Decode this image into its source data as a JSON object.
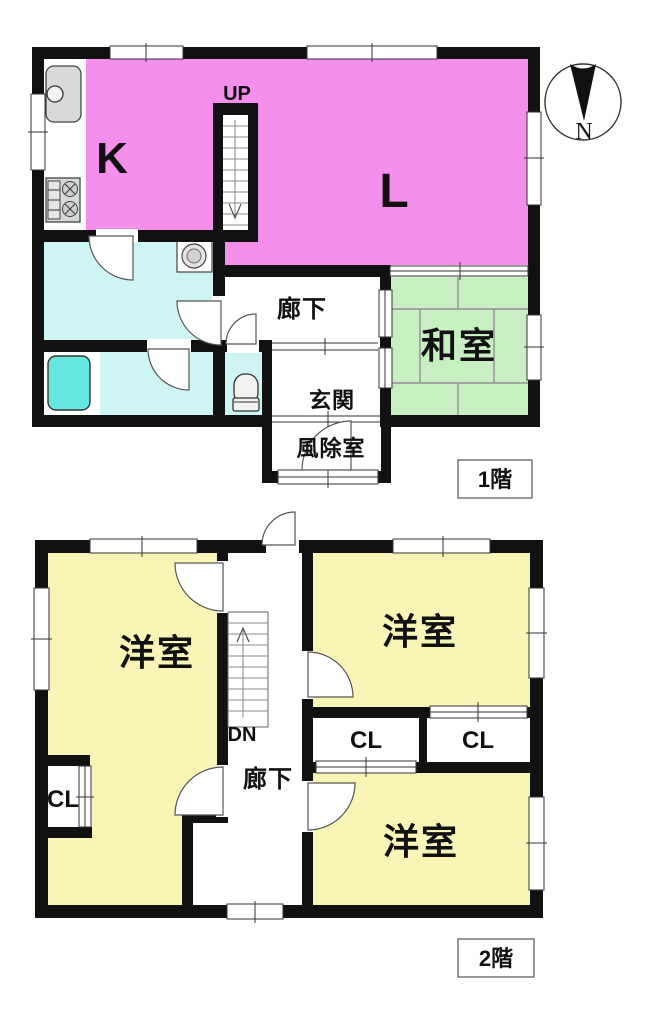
{
  "floor1": {
    "floor_label": "1階",
    "stairs_label": "UP",
    "rooms": {
      "kitchen": "K",
      "living": "L",
      "japanese_room": "和室",
      "hallway": "廊下",
      "entrance": "玄関",
      "windbreak_room": "風除室"
    }
  },
  "floor2": {
    "floor_label": "2階",
    "stairs_label": "DN",
    "rooms": {
      "western_room_left": "洋室",
      "western_room_top_right": "洋室",
      "western_room_bottom_right": "洋室",
      "hallway": "廊下"
    },
    "closets": {
      "left": "CL",
      "middle": "CL",
      "right": "CL"
    }
  },
  "compass": {
    "north_label": "N"
  },
  "colors": {
    "room_pink": "#F48FEB",
    "room_green": "#C8EFC2",
    "room_yellow": "#F8F5B6",
    "room_cyan": "#CDF5F3",
    "bathtub_cyan": "#66E6E0",
    "wall": "#111111"
  }
}
